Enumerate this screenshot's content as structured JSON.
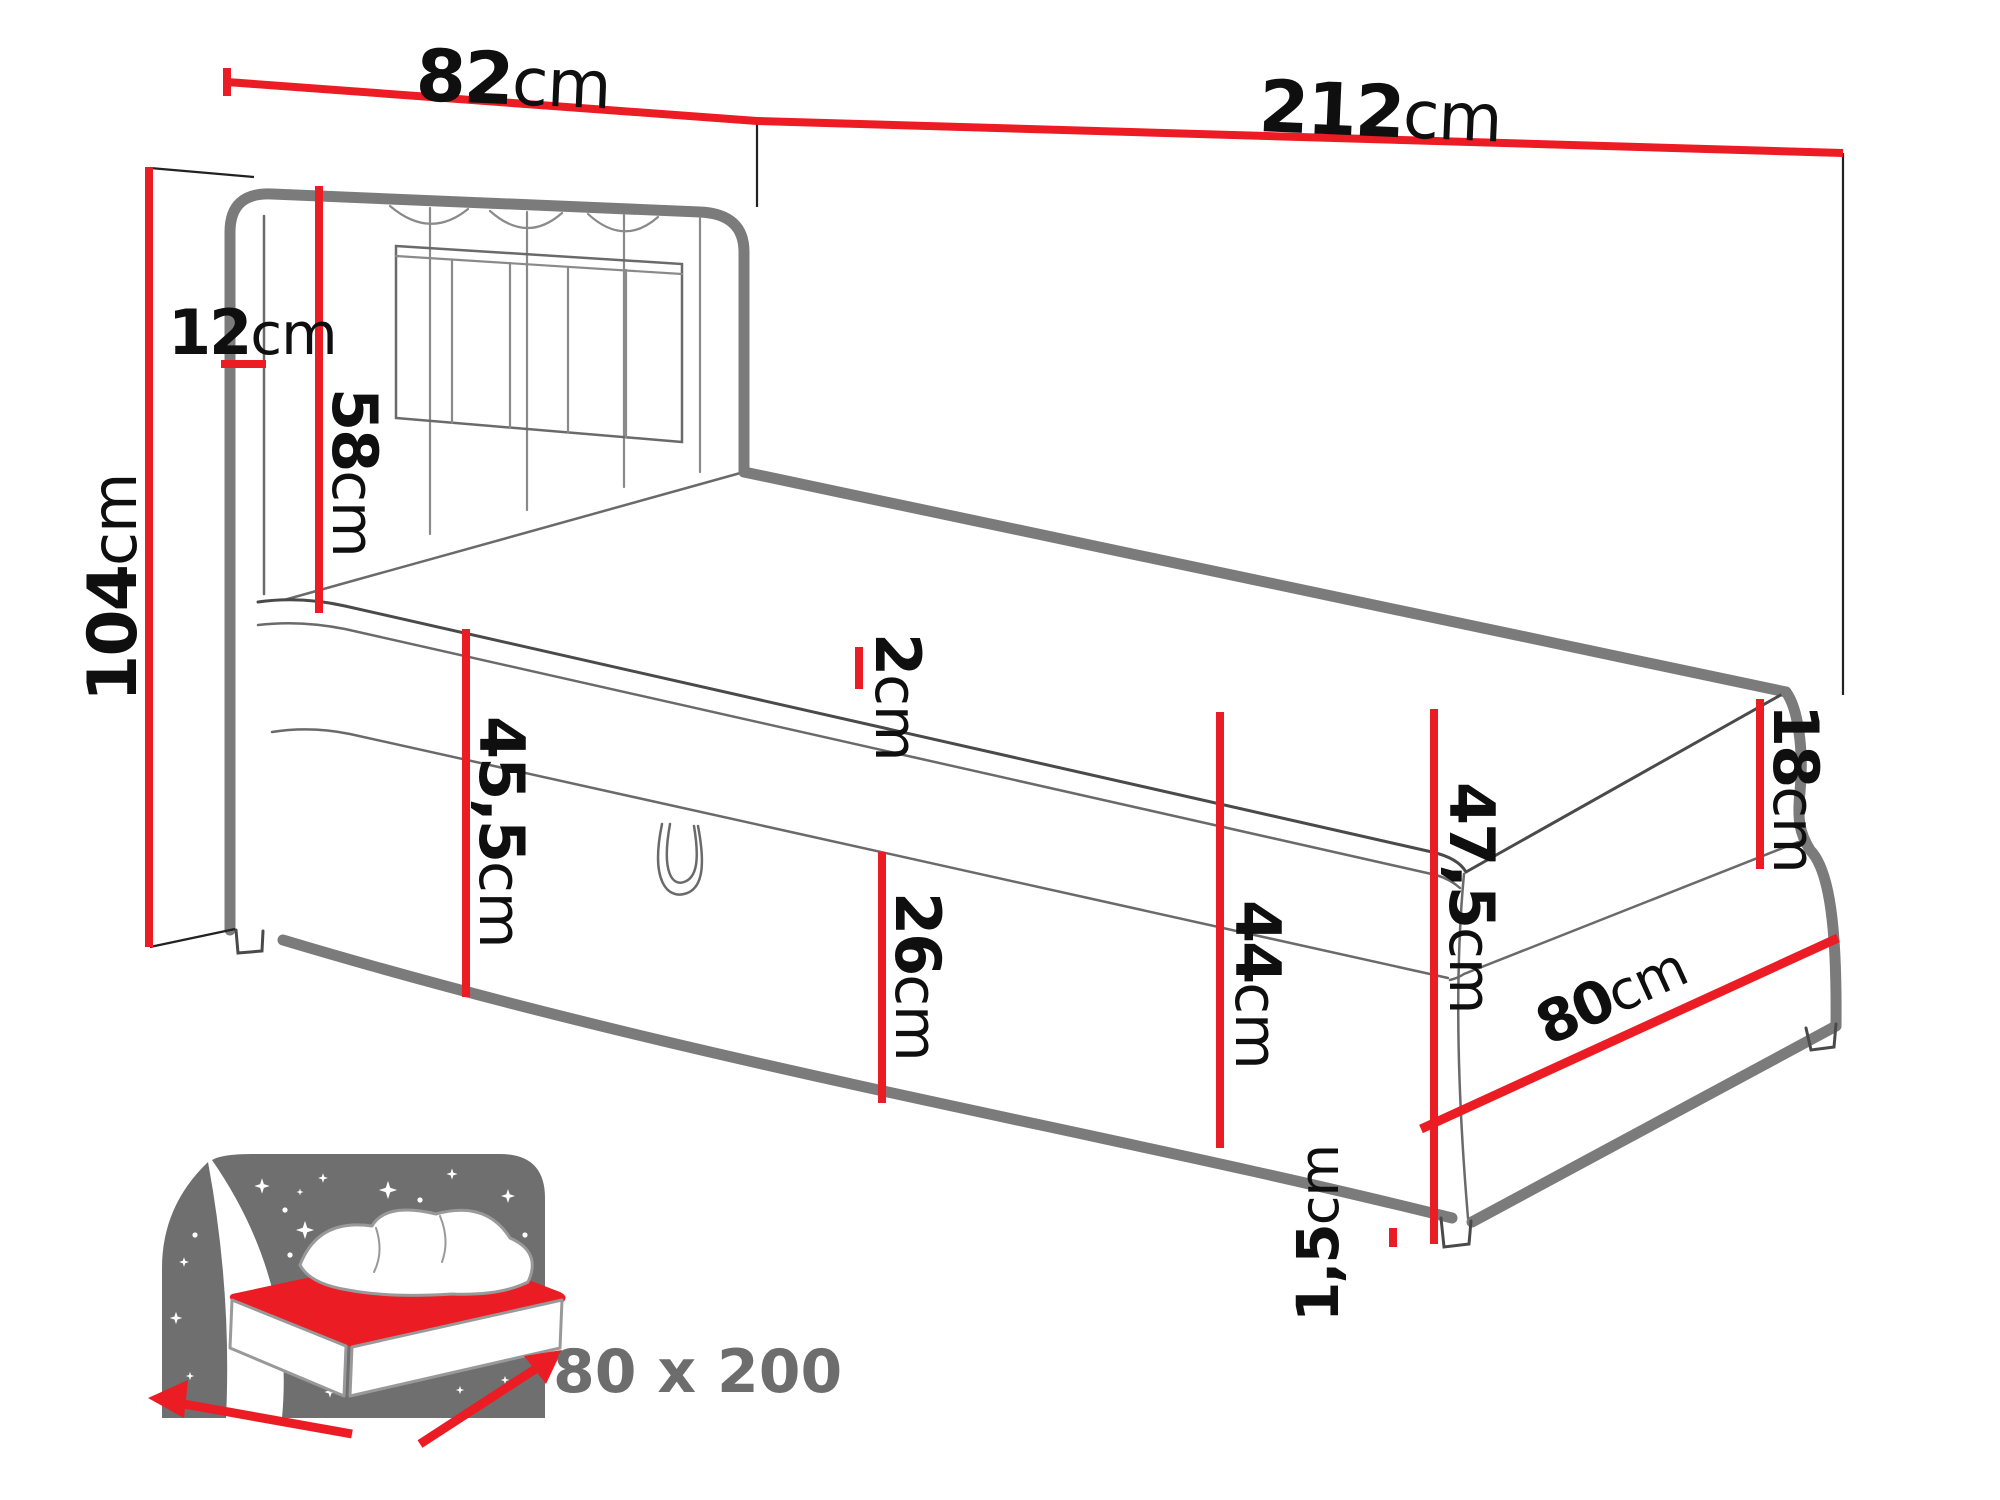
{
  "page": {
    "background": "#ffffff"
  },
  "colors": {
    "dimension_red": "#EC1C24",
    "outline_gray": "#7B7B7B",
    "icon_gray": "#6f6f6f",
    "badge_gray": "#6D6D6D",
    "text_black": "#0f0f0f"
  },
  "diagram": {
    "dimensions": {
      "headboard_width": {
        "value": "82",
        "unit": "cm"
      },
      "total_length": {
        "value": "212",
        "unit": "cm"
      },
      "headboard_height": {
        "value": "104",
        "unit": "cm"
      },
      "headboard_thickness": {
        "value": "12",
        "unit": "cm"
      },
      "headboard_panel_height": {
        "value": "58",
        "unit": "cm"
      },
      "topper_thickness": {
        "value": "2",
        "unit": "cm"
      },
      "side_height_front": {
        "value": "45,5",
        "unit": "cm"
      },
      "storage_box_height": {
        "value": "26",
        "unit": "cm"
      },
      "side_height_foot": {
        "value": "44",
        "unit": "cm"
      },
      "mattress_thickness": {
        "value": "18",
        "unit": "cm"
      },
      "total_base_height": {
        "value": "47,5",
        "unit": "cm"
      },
      "bed_width": {
        "value": "80",
        "unit": "cm"
      },
      "leg_height": {
        "value": "1,5",
        "unit": "cm"
      }
    },
    "size_badge": {
      "label": "80 x 200"
    }
  }
}
